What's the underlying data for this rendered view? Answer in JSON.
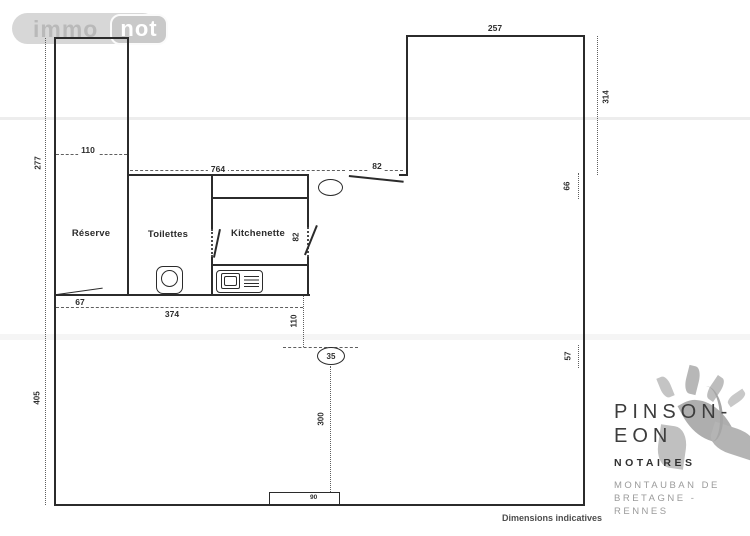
{
  "brand": {
    "immo": "immo",
    "not": "not"
  },
  "plan": {
    "rooms": {
      "reserve": "Réserve",
      "toilettes": "Toilettes",
      "kitchenette": "Kitchenette"
    },
    "dims": {
      "tr_width": "257",
      "right_outer": "314",
      "tower_width": "110",
      "left_upper": "277",
      "left_lower": "405",
      "total_width": "764",
      "door_top": "82",
      "door_kitchenette": "82",
      "door_reserve": "67",
      "rooms_width": "374",
      "offset_below_rooms": "110",
      "pole_diameter": "35",
      "pole_to_front": "300",
      "entry_width": "90",
      "right_window_upper": "66",
      "right_window_lower": "57"
    },
    "footnote": "Dimensions indicatives"
  },
  "notary": {
    "name_line1": "PINSON-",
    "name_line2": "EON",
    "subtitle": "NOTAIRES",
    "address_line1": "MONTAUBAN DE",
    "address_line2": "BRETAGNE -",
    "address_line3": "RENNES"
  }
}
